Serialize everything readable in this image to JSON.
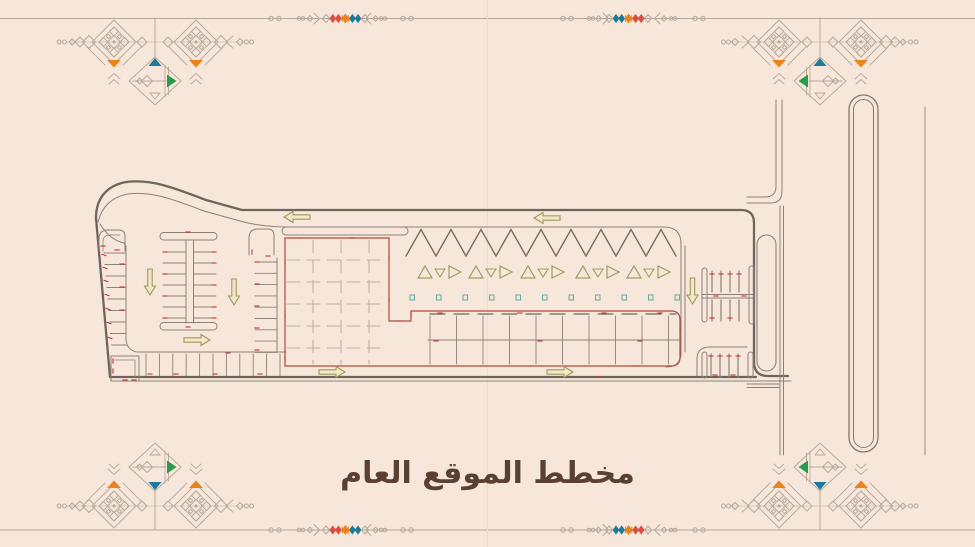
{
  "title": {
    "text": "مخطط الموقع العام"
  },
  "palette": {
    "background": "#f7e7da",
    "border_line": "#b3a89b",
    "ornament_line": "#b6aa9d",
    "road_dark": "#6e665d",
    "road_medium": "#8b8177",
    "road_light": "#9a9187",
    "plan_red": "#b3493c",
    "tick_red": "#c03a2c",
    "grid_line": "#ae9d8d",
    "arrow_olive": "#a2965c",
    "arrow_fill": "#f1e7c9",
    "symbol_olive": "#a89a5f",
    "symbol_teal": "#63aaa2",
    "accent_red": "#d94f43",
    "accent_orange": "#e8831e",
    "accent_teal": "#1d7a99",
    "accent_green": "#279b47",
    "title_color": "#594132",
    "guide_line": "#eedcca"
  },
  "ornaments": {
    "corners": [
      "top-left",
      "top-right",
      "bottom-left",
      "bottom-right"
    ],
    "accent_shapes": [
      "orange-triangle",
      "teal-triangle",
      "green-triangle"
    ],
    "border_motif_colors": [
      "red",
      "orange",
      "teal"
    ]
  },
  "plan": {
    "kind": "architectural-site-plan",
    "arrows": [
      {
        "name": "top-road-arrow-1",
        "dir": "left"
      },
      {
        "name": "top-road-arrow-2",
        "dir": "left"
      },
      {
        "name": "left-aisle-arrow",
        "dir": "down"
      },
      {
        "name": "center-aisle-arrow",
        "dir": "down"
      },
      {
        "name": "right-aisle-arrow",
        "dir": "down"
      },
      {
        "name": "mid-aisle-arrow",
        "dir": "right"
      },
      {
        "name": "lower-aisle-arrow-1",
        "dir": "right"
      },
      {
        "name": "lower-aisle-arrow-2",
        "dir": "right"
      }
    ]
  }
}
